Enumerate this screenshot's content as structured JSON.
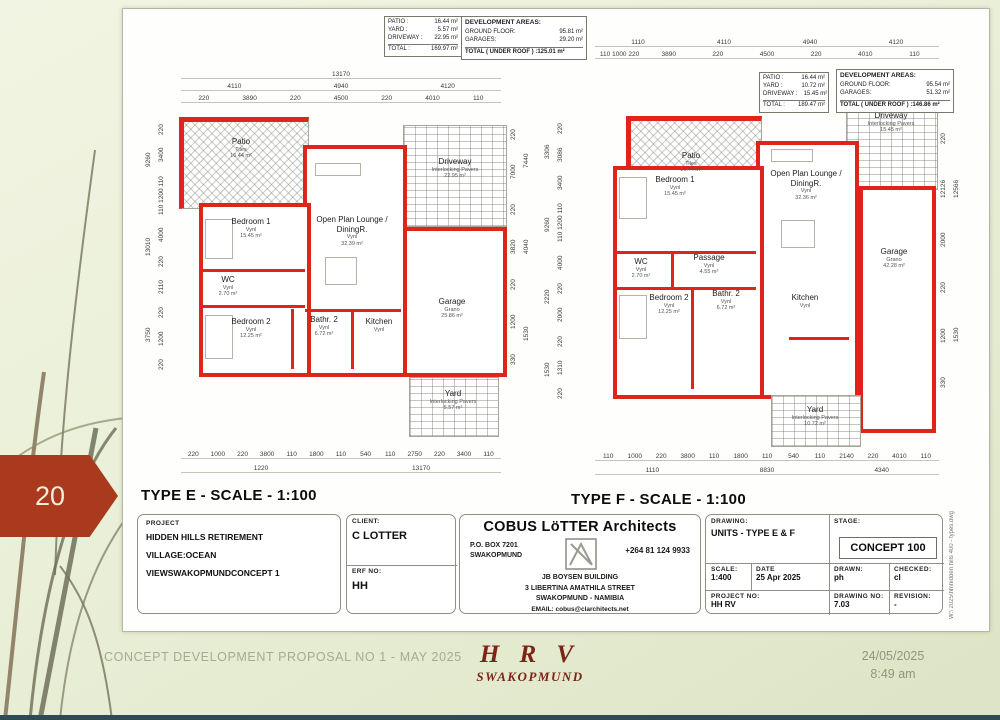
{
  "page_banner": {
    "number": "20"
  },
  "slide_footer": {
    "proposal": "CONCEPT DEVELOPMENT PROPOSAL NO 1 - MAY 2025",
    "logo_top": "H R V",
    "logo_bottom": "SWAKOPMUND",
    "date": "24/05/2025",
    "time": "8:49 am"
  },
  "sheet": {
    "file_note": "W:\\ 2025\\hh\\hidden hills 400 - types.dwg",
    "plans": [
      {
        "title": "TYPE E - SCALE - 1:100",
        "summary": {
          "rows": [
            [
              "PATIO :",
              "16.44 m²"
            ],
            [
              "YARD :",
              "5.57 m²"
            ],
            [
              "DRIVEWAY :",
              "22.95 m²"
            ]
          ],
          "total_rows": [
            [
              "TOTAL :",
              "169.97 m²"
            ]
          ]
        },
        "development": {
          "title": "DEVELOPMENT AREAS:",
          "rows": [
            [
              "GROUND FLOOR:",
              "95.81 m²"
            ],
            [
              "GARAGES:",
              "29.20 m²"
            ]
          ],
          "total": "TOTAL ( UNDER ROOF ) :125.01 m²"
        },
        "dims": {
          "top1": [
            "13170"
          ],
          "top2": [
            "4110",
            "4940",
            "4120"
          ],
          "top3": [
            "220",
            "3890",
            "220",
            "4500",
            "220",
            "4010",
            "110"
          ],
          "bottom1": [
            "220",
            "1000",
            "220",
            "3800",
            "110",
            "1800",
            "110",
            "540",
            "110",
            "2750",
            "220",
            "3400",
            "110"
          ],
          "bottom2": [
            "1220",
            "13170"
          ],
          "left_outer": [
            "3750",
            "13010",
            "9260"
          ],
          "left_inner": [
            "220",
            "1200",
            "220",
            "2110",
            "220",
            "4000",
            "110 1200 110",
            "3400",
            "220"
          ],
          "right_outer": [
            "1530",
            "4040",
            "7440"
          ],
          "right_inner": [
            "330",
            "1200",
            "220",
            "3820",
            "220",
            "7000",
            "220"
          ]
        },
        "rooms": {
          "patio": {
            "name": "Patio",
            "finish": "Tiles",
            "area": "16.44 m²"
          },
          "driveway": {
            "name": "Driveway",
            "finish": "Interlocking Pavers",
            "area": "22.95 m²"
          },
          "bedroom1": {
            "name": "Bedroom 1",
            "finish": "Vynl",
            "area": "15.45 m²"
          },
          "lounge": {
            "name": "Open Plan Lounge / DiningR.",
            "finish": "Vynl",
            "area": "32.39 m²"
          },
          "wc": {
            "name": "WC",
            "finish": "Vynl",
            "area": "2.70 m²"
          },
          "bedroom2": {
            "name": "Bedroom 2",
            "finish": "Vynl",
            "area": "12.25 m²"
          },
          "bath2": {
            "name": "Bathr. 2",
            "finish": "Vynl",
            "area": "6.72 m²"
          },
          "kitchen": {
            "name": "Kitchen",
            "finish": "Vynl"
          },
          "garage": {
            "name": "Garage",
            "finish": "Grano",
            "area": "25.86 m²"
          },
          "yard": {
            "name": "Yard",
            "finish": "Interlocking Pavers",
            "area": "5.57 m²"
          }
        }
      },
      {
        "title": "TYPE F - SCALE - 1:100",
        "summary": {
          "rows": [
            [
              "PATIO :",
              "16.44 m²"
            ],
            [
              "YARD :",
              "10.72 m²"
            ],
            [
              "DRIVEWAY :",
              "15.45 m²"
            ]
          ],
          "total_rows": [
            [
              "TOTAL :",
              "189.47 m²"
            ]
          ]
        },
        "development": {
          "title": "DEVELOPMENT AREAS:",
          "rows": [
            [
              "GROUND FLOOR:",
              "95.54 m²"
            ],
            [
              "GARAGES:",
              "51.32 m²"
            ]
          ],
          "total": "TOTAL ( UNDER ROOF ) :146.86 m²"
        },
        "dims": {
          "top1": [
            "1110",
            "4110",
            "4940",
            "4120"
          ],
          "top2": [
            "110 1000 220",
            "3890",
            "220",
            "4500",
            "220",
            "4010",
            "110"
          ],
          "bottom1": [
            "110",
            "1000",
            "220",
            "3800",
            "110",
            "1800",
            "110",
            "540",
            "110",
            "2140",
            "220",
            "4010",
            "110"
          ],
          "bottom2": [
            "1110",
            "8830",
            "4340"
          ],
          "left_outer": [
            "1530",
            "2220",
            "9260",
            "3306"
          ],
          "left_inner": [
            "220",
            "1310",
            "220",
            "2000",
            "220",
            "4000",
            "110 1200 110",
            "3400",
            "3086",
            "220"
          ],
          "right_outer": [
            "1530",
            "12566"
          ],
          "right_inner": [
            "330",
            "1200",
            "220",
            "2000",
            "12126",
            "220"
          ]
        },
        "rooms": {
          "patio": {
            "name": "Patio",
            "finish": "Tiles",
            "area": "16.44 m²"
          },
          "driveway": {
            "name": "Driveway",
            "finish": "Interlocking Pavers",
            "area": "15.45 m²"
          },
          "bedroom1": {
            "name": "Bedroom 1",
            "finish": "Vynl",
            "area": "15.45 m²"
          },
          "lounge": {
            "name": "Open Plan Lounge / DiningR.",
            "finish": "Vynl",
            "area": "32.36 m²"
          },
          "wc": {
            "name": "WC",
            "finish": "Vynl",
            "area": "2.70 m²"
          },
          "passage": {
            "name": "Passage",
            "finish": "Vynl",
            "area": "4.55 m²"
          },
          "bedroom2": {
            "name": "Bedroom 2",
            "finish": "Vynl",
            "area": "12.25 m²"
          },
          "bath2": {
            "name": "Bathr. 2",
            "finish": "Vynl",
            "area": "6.72 m²"
          },
          "kitchen": {
            "name": "Kitchen",
            "finish": "Vynl"
          },
          "garage": {
            "name": "Garage",
            "finish": "Grano",
            "area": "42.28 m²"
          },
          "yard": {
            "name": "Yard",
            "finish": "Interlocking Pavers",
            "area": "10.72 m²"
          }
        }
      }
    ],
    "title_block": {
      "project": {
        "label": "PROJECT",
        "lines": [
          "HIDDEN HILLS RETIREMENT VILLAGE:",
          "OCEAN VIEW",
          "SWAKOPMUND",
          "CONCEPT 1"
        ]
      },
      "client": {
        "label": "CLIENT:",
        "value": "C LOTTER"
      },
      "erf": {
        "label": "ERF NO:",
        "value": "HH"
      },
      "architect": {
        "name": "COBUS LöTTER Architects",
        "po_box": "P.O. BOX 7201",
        "po_city": "SWAKOPMUND",
        "phone": "+264 81 124 9933",
        "address1": "JB BOYSEN BUILDING",
        "address2": "3 LIBERTINA AMATHILA STREET",
        "address3": "SWAKOPMUND - NAMIBIA",
        "email": "EMAIL: cobus@clarchitects.net"
      },
      "drawing": {
        "label": "DRAWING:",
        "value": "UNITS - TYPE E & F"
      },
      "stage": {
        "label": "STAGE:",
        "value": "CONCEPT 100"
      },
      "scale": {
        "label": "SCALE:",
        "value": "1:400"
      },
      "date": {
        "label": "DATE",
        "value": "25 Apr 2025"
      },
      "drawn": {
        "label": "DRAWN:",
        "value": "ph"
      },
      "checked": {
        "label": "CHECKED:",
        "value": "cl"
      },
      "project_no": {
        "label": "PROJECT NO:",
        "value": "HH RV"
      },
      "drawing_no": {
        "label": "DRAWING NO:",
        "value": "7.03"
      },
      "revision": {
        "label": "REVISION:",
        "value": "-"
      }
    }
  }
}
